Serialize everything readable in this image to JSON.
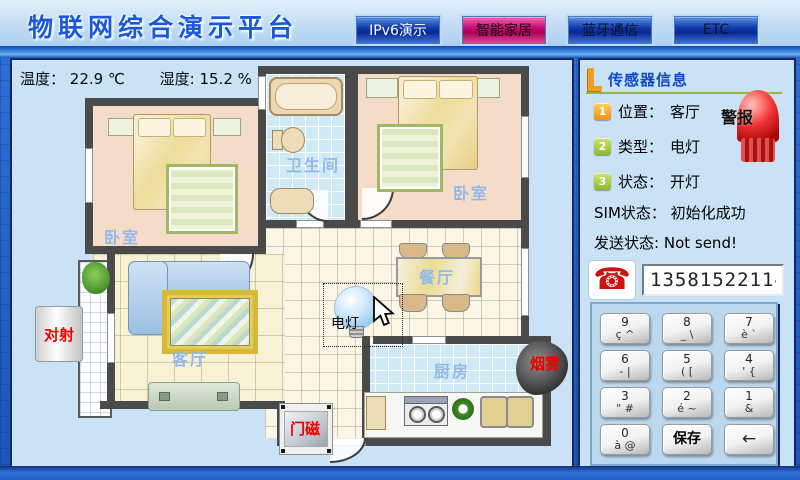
{
  "header": {
    "title": "物联网综合演示平台",
    "tabs": [
      {
        "label": "IPv6演示"
      },
      {
        "label": "智能家居"
      },
      {
        "label": "蓝牙通信"
      },
      {
        "label": "ETC"
      }
    ]
  },
  "environment": {
    "temperature": {
      "label": "温度：",
      "value": "22.9",
      "unit": "℃"
    },
    "humidity": {
      "label": "湿度:",
      "value": "15.2",
      "unit": "%"
    }
  },
  "floorplan": {
    "rooms": {
      "bathroom": "卫生间",
      "bedroom_left": "卧室",
      "bedroom_right": "卧室",
      "dining": "餐厅",
      "living": "客厅",
      "kitchen": "厨房"
    },
    "sensors": {
      "beam": "对射",
      "lamp": "电灯",
      "door_magnet": "门磁",
      "smoke": "烟雾"
    }
  },
  "sidebar": {
    "title": "传感器信息",
    "alarm_label": "警报",
    "items": [
      {
        "num": "1",
        "label": "位置：",
        "value": "客厅"
      },
      {
        "num": "2",
        "label": "类型：",
        "value": "电灯"
      },
      {
        "num": "3",
        "label": "状态：",
        "value": "开灯"
      }
    ],
    "sim_label": "SIM状态：",
    "sim_value": "初始化成功",
    "send_label": "发送状态:",
    "send_value": "Not send!",
    "phone_number": "13581522114",
    "keypad": {
      "keys": [
        {
          "main": "9",
          "sub": "ç ^"
        },
        {
          "main": "8",
          "sub": "_ \\"
        },
        {
          "main": "7",
          "sub": "è `"
        },
        {
          "main": "6",
          "sub": "- |"
        },
        {
          "main": "5",
          "sub": "( ["
        },
        {
          "main": "4",
          "sub": "' {"
        },
        {
          "main": "3",
          "sub": "\" #"
        },
        {
          "main": "2",
          "sub": "é ~"
        },
        {
          "main": "1",
          "sub": "&"
        },
        {
          "main": "0",
          "sub": "à @"
        }
      ],
      "save_label": "保存",
      "backspace_label": "←"
    }
  },
  "colors": {
    "accent_blue": "#1b58d8",
    "tab_active_magenta": "#c80a6e",
    "alarm_red": "#f23232",
    "sensor_label_red": "#ee0000"
  }
}
